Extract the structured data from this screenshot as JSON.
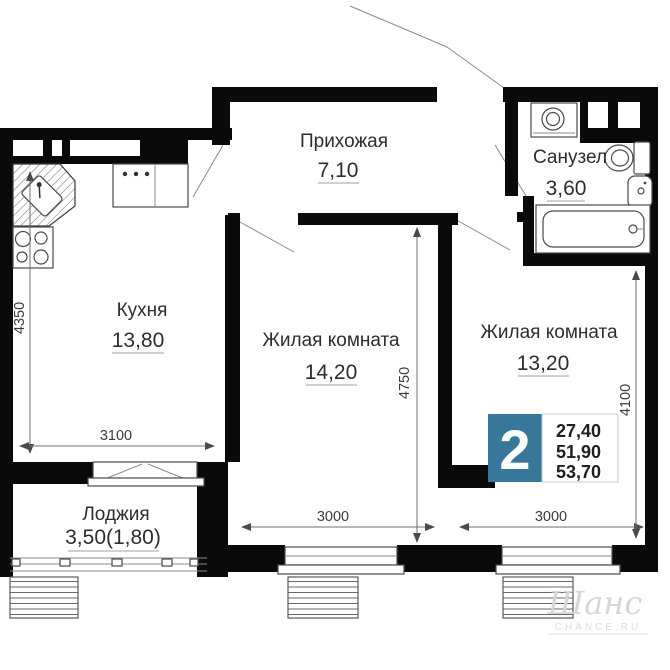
{
  "plan": {
    "rooms": [
      {
        "name": "Прихожая",
        "area": "7,10"
      },
      {
        "name": "Санузел",
        "area": "3,60"
      },
      {
        "name": "Кухня",
        "area": "13,80"
      },
      {
        "name": "Жилая комната",
        "area": "14,20"
      },
      {
        "name": "Жилая комната",
        "area": "13,20"
      },
      {
        "name": "Лоджия",
        "area": "3,50(1,80)"
      }
    ],
    "dimensions_mm": {
      "kitchen_height": "4350",
      "kitchen_window_width": "3100",
      "room1_height": "4750",
      "room1_window_width": "3000",
      "room2_height": "4100",
      "room2_window_width": "3000"
    },
    "info_badge": {
      "room_count": "2",
      "areas": [
        "27,40",
        "51,90",
        "53,70"
      ],
      "accent_color": "#37789a"
    },
    "watermark": {
      "logo_text": "Шанс",
      "caption": "CHANCE.RU"
    },
    "fixtures": [
      "corner-sink-icon",
      "cooktop-icon",
      "stove-icon",
      "washing-machine-icon",
      "toilet-icon",
      "washbasin-icon",
      "bathtub-icon"
    ]
  }
}
